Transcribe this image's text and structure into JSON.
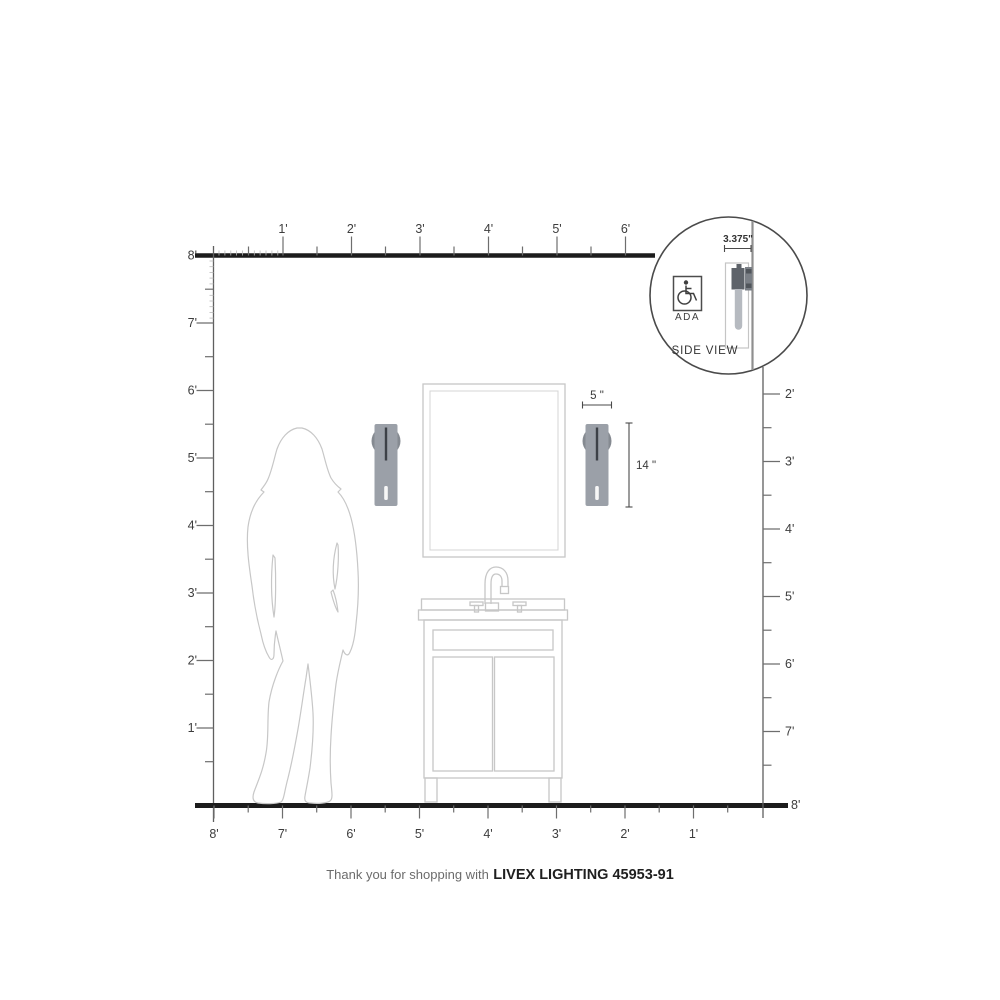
{
  "footer": {
    "prefix": "Thank you for shopping with",
    "product": "LIVEX LIGHTING 45953-91"
  },
  "inset": {
    "dimension_label": "3.375\"",
    "ada_label": "ADA",
    "view_label": "SIDE VIEW"
  },
  "sconce_dimensions": {
    "width_label": "5 \"",
    "height_label": "14 \""
  },
  "rulers": {
    "top": {
      "labels": [
        "1'",
        "2'",
        "3'",
        "4'",
        "5'",
        "6'"
      ]
    },
    "left": {
      "labels": [
        "8'",
        "7'",
        "6'",
        "5'",
        "4'",
        "3'",
        "2'",
        "1'"
      ]
    },
    "right": {
      "labels": [
        "2'",
        "3'",
        "4'",
        "5'",
        "6'",
        "7'",
        "8'"
      ]
    },
    "bottom": {
      "labels": [
        "8'",
        "7'",
        "6'",
        "5'",
        "4'",
        "3'",
        "2'",
        "1'"
      ]
    }
  },
  "colors": {
    "structure_line": "#1c1c1c",
    "outline_light": "#c7c7c7",
    "sconce_body": "#9ba0a8",
    "sconce_backplate": "#858a91",
    "sconce_accent": "#3d4147",
    "glass": "#b6bac0"
  }
}
